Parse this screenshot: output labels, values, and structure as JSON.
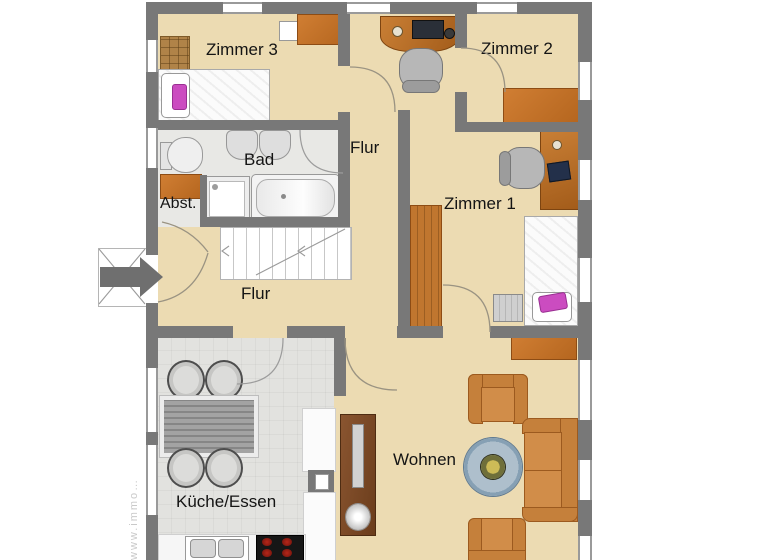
{
  "plan": {
    "type": "floor-plan",
    "language": "de",
    "watermark": "www.immo…",
    "rooms": {
      "zimmer3": {
        "label": "Zimmer 3"
      },
      "zimmer2": {
        "label": "Zimmer 2"
      },
      "zimmer1": {
        "label": "Zimmer 1"
      },
      "bad": {
        "label": "Bad"
      },
      "flur_upper": {
        "label": "Flur"
      },
      "flur_lower": {
        "label": "Flur"
      },
      "abstellraum": {
        "label": "Abst."
      },
      "kueche": {
        "label": "Küche/Essen"
      },
      "wohnen": {
        "label": "Wohnen"
      }
    },
    "furniture": [
      "double-bed",
      "single-bed",
      "dresser",
      "wardrobe",
      "storage-cabinet",
      "sideboard",
      "desk-with-computer",
      "office-chair",
      "toilet",
      "washbasin",
      "washbasin",
      "shower",
      "bathtub",
      "staircase",
      "dining-table",
      "dining-chair",
      "kitchen-counter",
      "kitchen-sink",
      "stove",
      "sofa",
      "armchair",
      "coffee-table",
      "tv-sideboard",
      "plant"
    ],
    "colors": {
      "wall": "#787878",
      "floor_tan": "#ecdbb2",
      "floor_gray": "#e8e8e5",
      "furniture_orange": "#c6752f",
      "accent_pink": "#cb4cc0",
      "table_blue": "#8aa0b4",
      "stove_burner": "#8f1d12"
    }
  }
}
